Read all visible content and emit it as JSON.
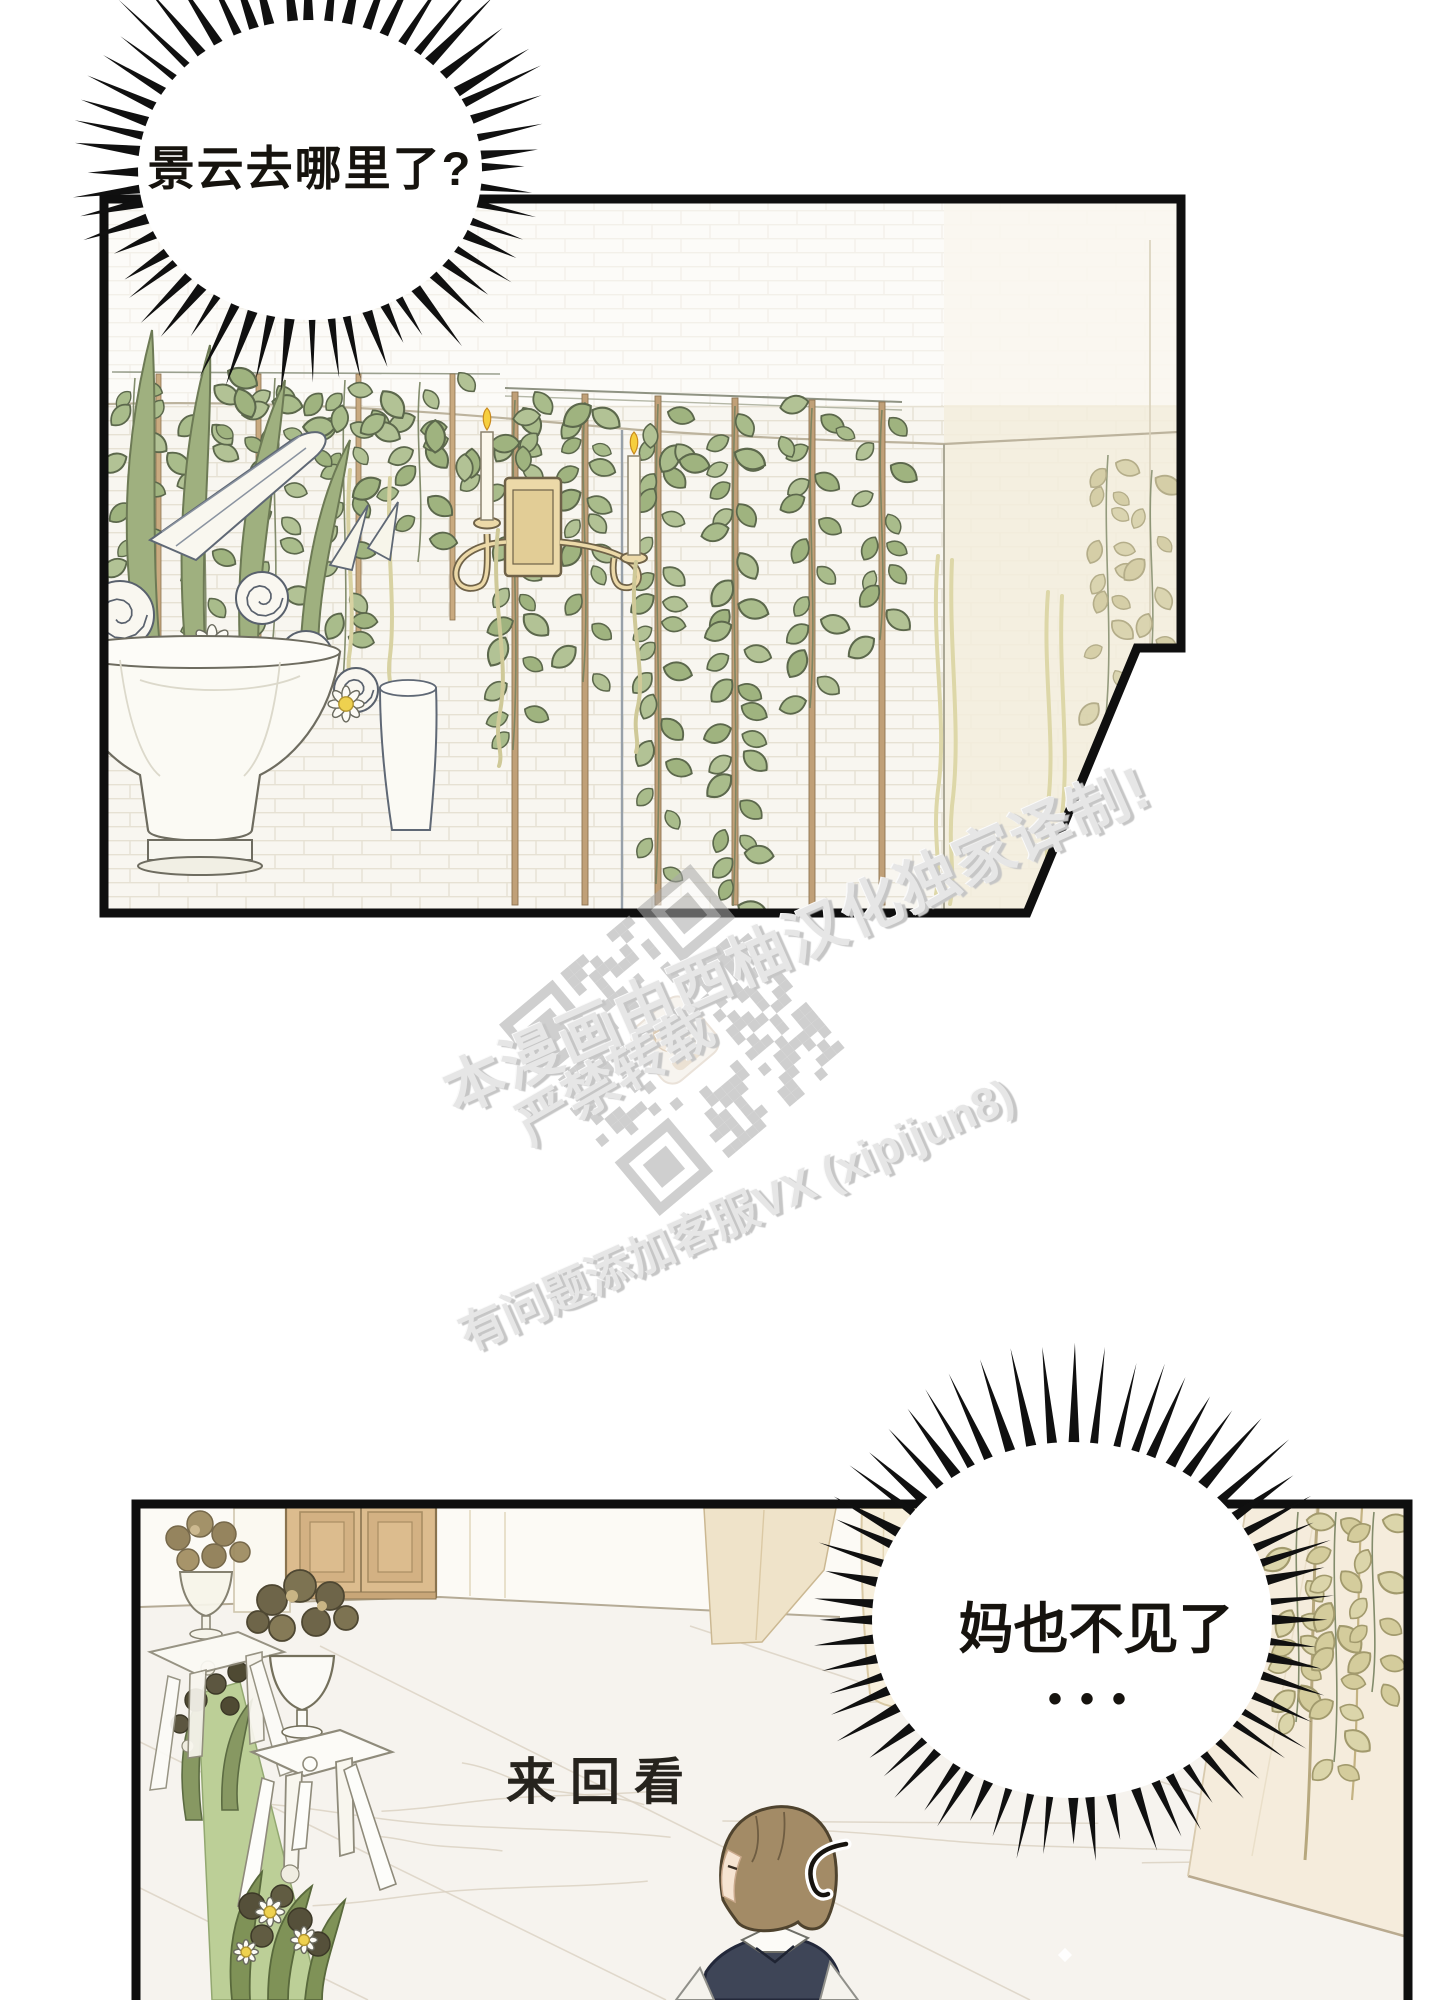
{
  "page": {
    "background": "#ffffff"
  },
  "bubbles": {
    "bubble1": {
      "text": "景云去哪里了?"
    },
    "bubble2": {
      "line1": "妈也不见了",
      "line2": "•••"
    }
  },
  "sfx": {
    "text": "来回看"
  },
  "watermark": {
    "line1": "本漫画由西柚汉化独家译制!",
    "line2": "严禁转载",
    "line3": "有问题添加客服VX (xipijun8)",
    "color": "#e6e6e6"
  },
  "colors": {
    "ink": "#111111",
    "leaf_green": "#a9bc8b",
    "pale_vine": "#d9d3a8",
    "sconce_brass": "#ecd9a8",
    "carpet_green": "#bccf97",
    "vest_navy": "#3e4557",
    "daisy_yellow": "#eed14f",
    "door_tan": "#dcbc8e"
  }
}
